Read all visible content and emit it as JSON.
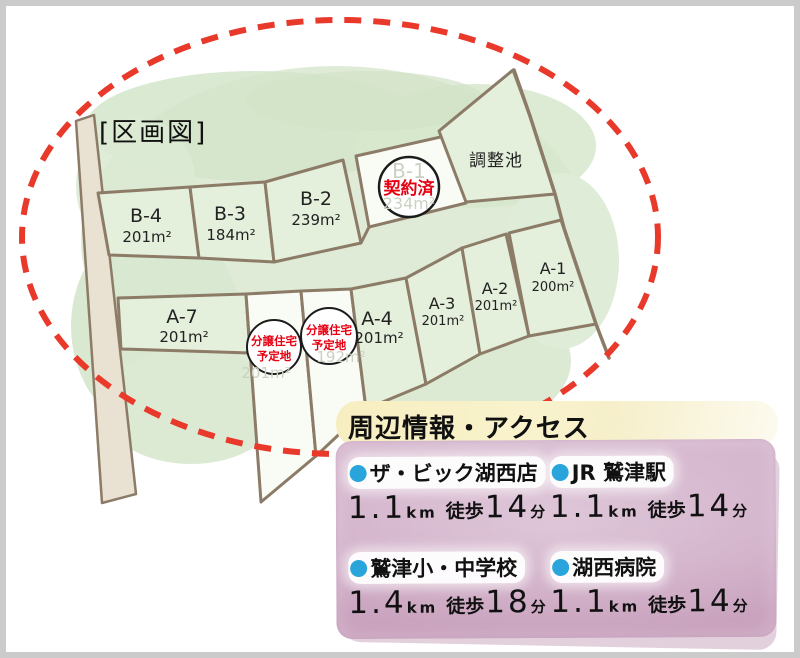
{
  "page": {
    "border_color": "#cbcbcb",
    "background": "#ffffff"
  },
  "map": {
    "title": "[区画図]",
    "pond_label": "調整池",
    "colors": {
      "boundary_red": "#e8392b",
      "line_brown": "#8c7b67",
      "parcel_green": "#e4efdc",
      "lot_white": "#f9fbf5",
      "road_beige": "#e9e1d1",
      "foliage_green": "#d8e7ce",
      "badge_red": "#e60012",
      "faint_text": "#c9d2c1"
    },
    "sold_lot": {
      "id": "B-1",
      "area": "234m²",
      "badge": "契約済"
    },
    "planned_badge": {
      "line1": "分譲住宅",
      "line2": "予定地"
    },
    "planned_lots": [
      {
        "faint_area": "201m²"
      },
      {
        "faint_area": "192m²"
      }
    ],
    "lots": [
      {
        "id": "B-4",
        "area": "201m²"
      },
      {
        "id": "B-3",
        "area": "184m²"
      },
      {
        "id": "B-2",
        "area": "239m²"
      },
      {
        "id": "A-7",
        "area": "201m²"
      },
      {
        "id": "A-4",
        "area": "201m²"
      },
      {
        "id": "A-3",
        "area": "201m²"
      },
      {
        "id": "A-2",
        "area": "201m²"
      },
      {
        "id": "A-1",
        "area": "200m²"
      }
    ]
  },
  "info": {
    "title": "周辺情報・アクセス",
    "panel_color": "#cfacc6",
    "highlight_color": "#f8f1c6",
    "bullet_color": "#2aa5dc",
    "items": [
      {
        "name": "ザ・ビック湖西店",
        "distance": "1.1",
        "unit": "km",
        "walk": "徒歩",
        "minutes": "14",
        "minutes_unit": "分"
      },
      {
        "name": "JR 鷲津駅",
        "distance": "1.1",
        "unit": "km",
        "walk": "徒歩",
        "minutes": "14",
        "minutes_unit": "分"
      },
      {
        "name": "鷲津小・中学校",
        "distance": "1.4",
        "unit": "km",
        "walk": "徒歩",
        "minutes": "18",
        "minutes_unit": "分"
      },
      {
        "name": "湖西病院",
        "distance": "1.1",
        "unit": "km",
        "walk": "徒歩",
        "minutes": "14",
        "minutes_unit": "分"
      }
    ]
  }
}
